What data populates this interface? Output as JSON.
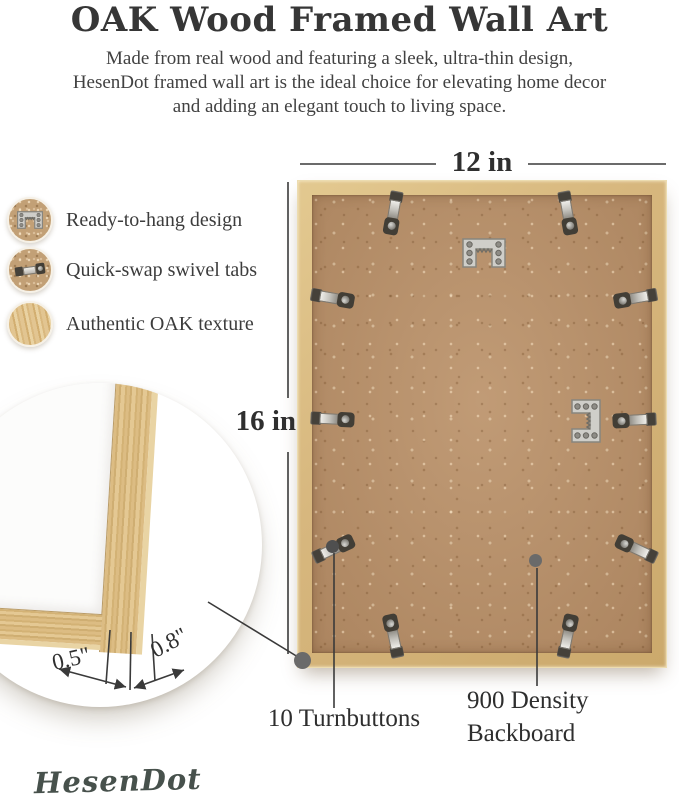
{
  "header": {
    "title": "OAK Wood Framed Wall Art",
    "description_lines": [
      "Made from real wood and featuring a sleek, ultra-thin design,",
      "HesenDot framed wall art is the ideal choice for elevating home decor",
      "and adding an elegant touch to living space."
    ]
  },
  "features": [
    {
      "icon": "sawtooth-hanger-icon",
      "label": "Ready-to-hang design"
    },
    {
      "icon": "swivel-tab-icon",
      "label": "Quick-swap swivel tabs"
    },
    {
      "icon": "oak-texture-icon",
      "label": "Authentic OAK texture"
    }
  ],
  "dimensions": {
    "width": "12 in",
    "height": "16 in"
  },
  "corner_detail": {
    "face_width": "0.5\"",
    "depth": "0.8\""
  },
  "callouts": {
    "turnbuttons": "10 Turnbuttons",
    "backboard": [
      "900 Density",
      "Backboard"
    ]
  },
  "brand": "HesenDot",
  "colors": {
    "oak": "#d7b77e",
    "backboard": "#b8906a",
    "metal": "#cfcec9",
    "annotation": "#3a3a3a"
  }
}
